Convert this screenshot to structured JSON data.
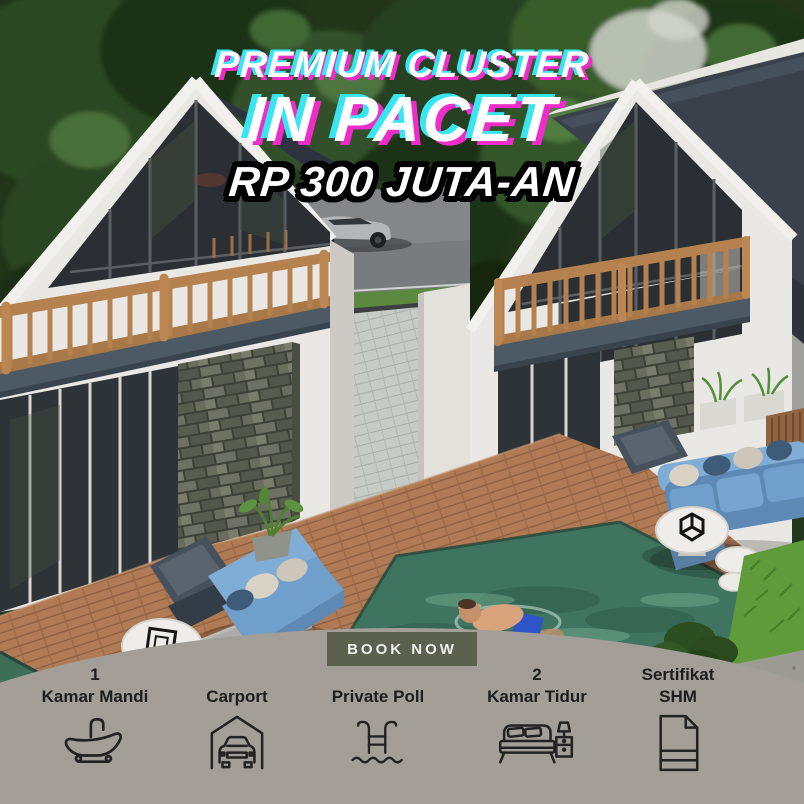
{
  "title": {
    "eyebrow": "PREMIUM CLUSTER",
    "location": "IN PACET",
    "price": "RP 300 JUTA-AN"
  },
  "cta": {
    "label": "BOOK NOW"
  },
  "features": {
    "items": [
      {
        "line1": "1",
        "line2": "Kamar Mandi",
        "icon": "bathtub-icon"
      },
      {
        "line1": "",
        "line2": "Carport",
        "icon": "carport-icon"
      },
      {
        "line1": "",
        "line2": "Private Poll",
        "icon": "pool-ladder-icon"
      },
      {
        "line1": "2",
        "line2": "Kamar Tidur",
        "icon": "bed-icon"
      },
      {
        "line1": "Sertifikat",
        "line2": "SHM",
        "icon": "certificate-icon"
      }
    ]
  },
  "colors": {
    "glitch_cyan": "#38e6f2",
    "glitch_magenta": "#ef2cc9",
    "title_text": "#ffffff",
    "price_outline": "#000000",
    "panel_bg": "#a49e99",
    "panel_text": "#1d1d1d",
    "button_bg": "#5b604f",
    "button_text": "#eef0ea"
  }
}
